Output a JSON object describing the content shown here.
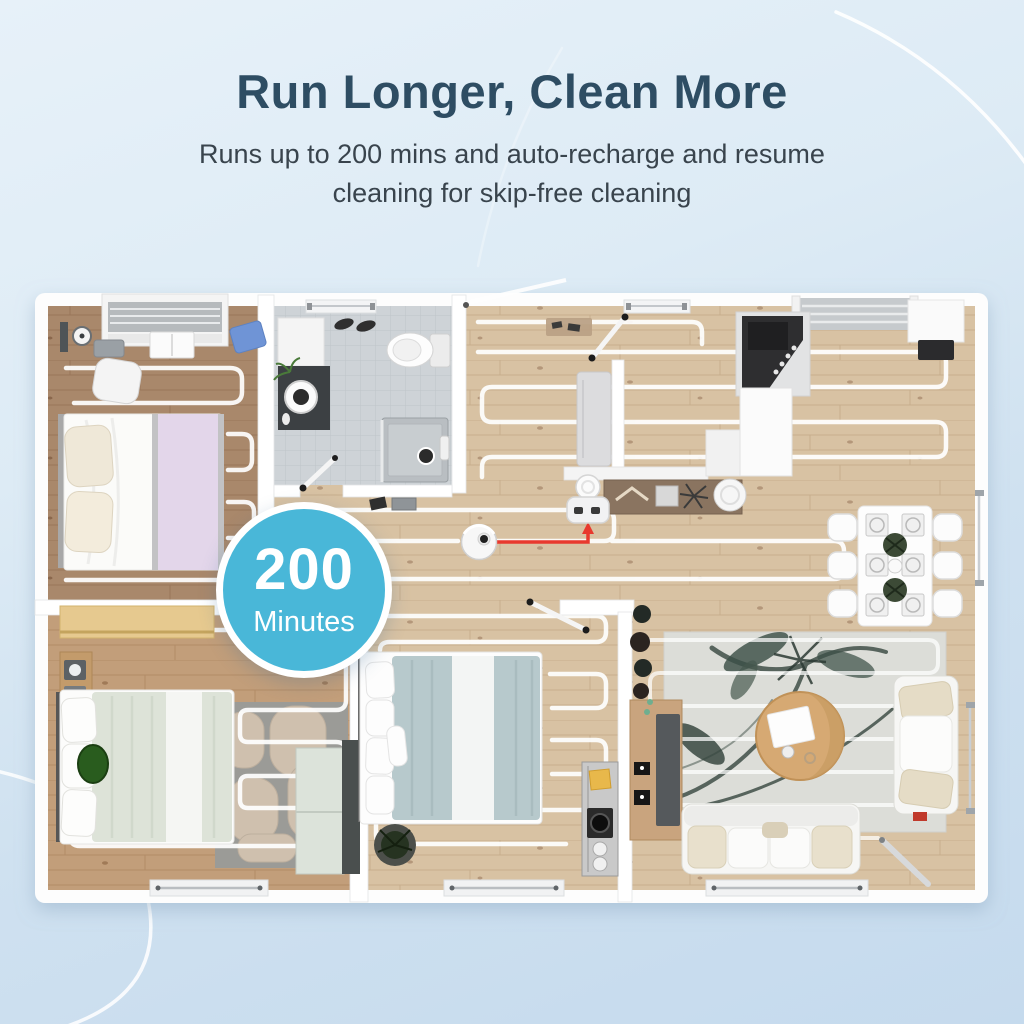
{
  "header": {
    "title": "Run Longer, Clean More",
    "subtitle_line1": "Runs up to 200 mins and auto-recharge and resume",
    "subtitle_line2": "cleaning for skip-free cleaning"
  },
  "badge": {
    "value": "200",
    "unit": "Minutes",
    "background": "#49b7d8",
    "ring_color": "#ffffff",
    "text_color": "#ffffff"
  },
  "colors": {
    "title": "#2e4d63",
    "subtitle": "#39444d",
    "page_background_top": "#e7f1f9",
    "page_background_bottom": "#c5daed",
    "robot_path_red": "#e8392e",
    "cleaning_path_white": "#ffffff",
    "wall_white": "#ffffff",
    "wood_light": "#d8c2a3",
    "wood_dark": "#a9886b",
    "tile_gray": "#ced3d7"
  },
  "floor_plan": {
    "description": "top-down apartment floor plan with robot vacuum cleaning paths",
    "icons": {
      "robot_vacuum": "robot-vacuum-icon",
      "charging_dock": "charging-dock-icon",
      "return_path": "robot-return-path"
    },
    "rooms": [
      "bedroom-1",
      "bathroom",
      "hallway",
      "kitchen-dining",
      "bedroom-2",
      "bedroom-3",
      "living-room"
    ]
  }
}
